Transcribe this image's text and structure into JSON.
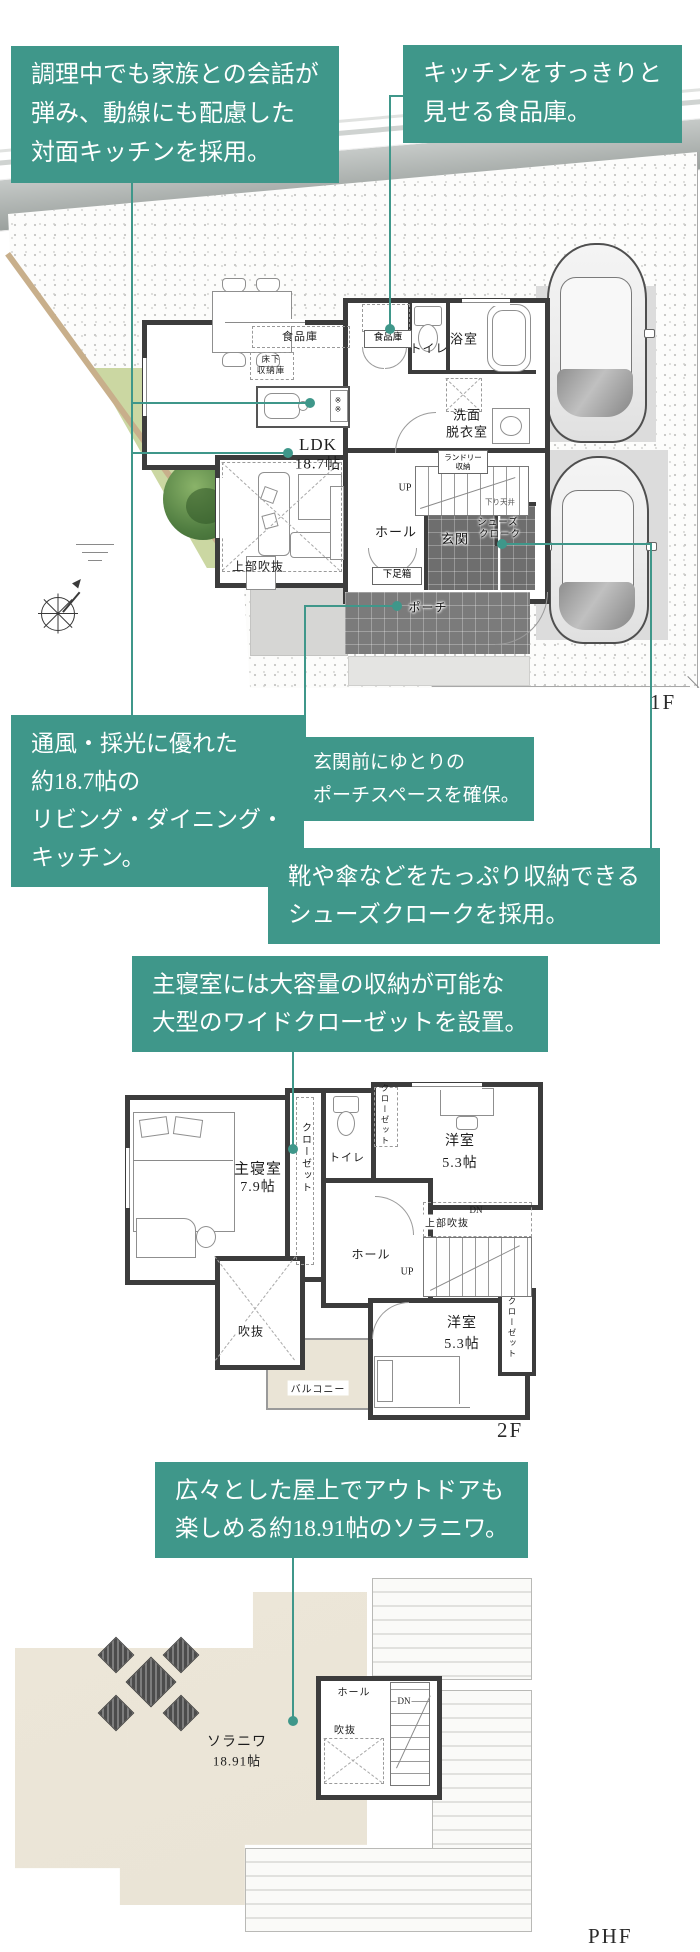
{
  "colors": {
    "accent_teal": "#3F978A",
    "wall_dark": "#3C3C3C",
    "garden_green": "#CBD7A2",
    "terrace_beige": "#EAE4D6",
    "tile_dark": "#6E6E6E",
    "pad_gray": "#DCDCDC"
  },
  "annotations": {
    "kitchen_counter": {
      "lines": [
        "調理中でも家族との会話が",
        "弾み、動線にも配慮した",
        "対面キッチンを採用。"
      ]
    },
    "pantry": {
      "lines": [
        "キッチンをすっきりと",
        "見せる食品庫。"
      ]
    },
    "ldk": {
      "lines": [
        "通風・採光に優れた",
        "約18.7帖の",
        "リビング・ダイニング・",
        "キッチン。"
      ]
    },
    "porch": {
      "lines": [
        "玄関前にゆとりの",
        "ポーチスペースを確保。"
      ]
    },
    "shoes_cloak": {
      "lines": [
        "靴や傘などをたっぷり収納できる",
        "シューズクロークを採用。"
      ]
    },
    "master_bedroom": {
      "lines": [
        "主寝室には大容量の収納が可能な",
        "大型のワイドクローゼットを設置。"
      ]
    },
    "soraniwa": {
      "lines": [
        "広々とした屋上でアウトドアも",
        "楽しめる約18.91帖のソラニワ。"
      ]
    }
  },
  "floor1": {
    "label": "1F",
    "rooms": {
      "pantry_long": "食品庫",
      "underfloor": [
        "床下",
        "収納庫"
      ],
      "pantry_small": "食品庫",
      "toilet": "トイレ",
      "bath": "浴室",
      "washroom": [
        "洗面",
        "脱衣室"
      ],
      "laundry": [
        "ランドリー",
        "収納"
      ],
      "ldk": [
        "LDK",
        "18.7帖"
      ],
      "up": "UP",
      "hall": "ホール",
      "genkan": "玄関",
      "shoes_cloak": [
        "シューズ",
        "クローク"
      ],
      "shoe_box": "下足箱",
      "porch": "ポーチ",
      "void_above": "上部吹抜",
      "lowered_ceiling": "下り天井",
      "stove_marks": "※※"
    }
  },
  "floor2": {
    "label": "2F",
    "rooms": {
      "master": [
        "主寝室",
        "7.9帖"
      ],
      "closet": "クローゼット",
      "toilet": "トイレ",
      "room_ne": [
        "洋室",
        "5.3帖"
      ],
      "room_se": [
        "洋室",
        "5.3帖"
      ],
      "hall": "ホール",
      "void_above": "上部吹抜",
      "dn": "DN",
      "up": "UP",
      "void": "吹抜",
      "balcony": "バルコニー"
    }
  },
  "phf": {
    "label": "PHF",
    "rooms": {
      "soraniwa": [
        "ソラニワ",
        "18.91帖"
      ],
      "hall": "ホール",
      "dn": "DN",
      "void": "吹抜"
    }
  }
}
